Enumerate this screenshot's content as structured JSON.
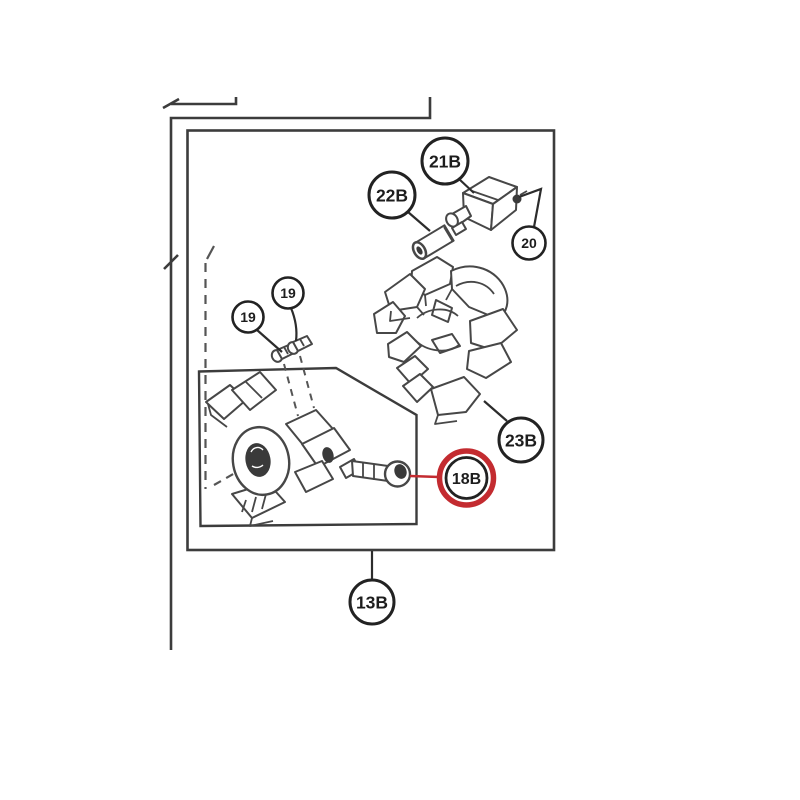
{
  "image": {
    "type": "exploded-parts-diagram",
    "background": "#ffffff",
    "colors": {
      "line": "#3c3c3c",
      "label_text": "#1d1d1d",
      "highlight_ring": "#c32b30"
    },
    "callouts": [
      {
        "label": "21B",
        "highlighted": false
      },
      {
        "label": "22B",
        "highlighted": false
      },
      {
        "label": "20",
        "highlighted": false
      },
      {
        "label": "19",
        "highlighted": false
      },
      {
        "label": "19",
        "highlighted": false
      },
      {
        "label": "23B",
        "highlighted": false
      },
      {
        "label": "18B",
        "highlighted": true
      },
      {
        "label": "13B",
        "highlighted": false
      }
    ],
    "highlighted_part": "18B"
  }
}
